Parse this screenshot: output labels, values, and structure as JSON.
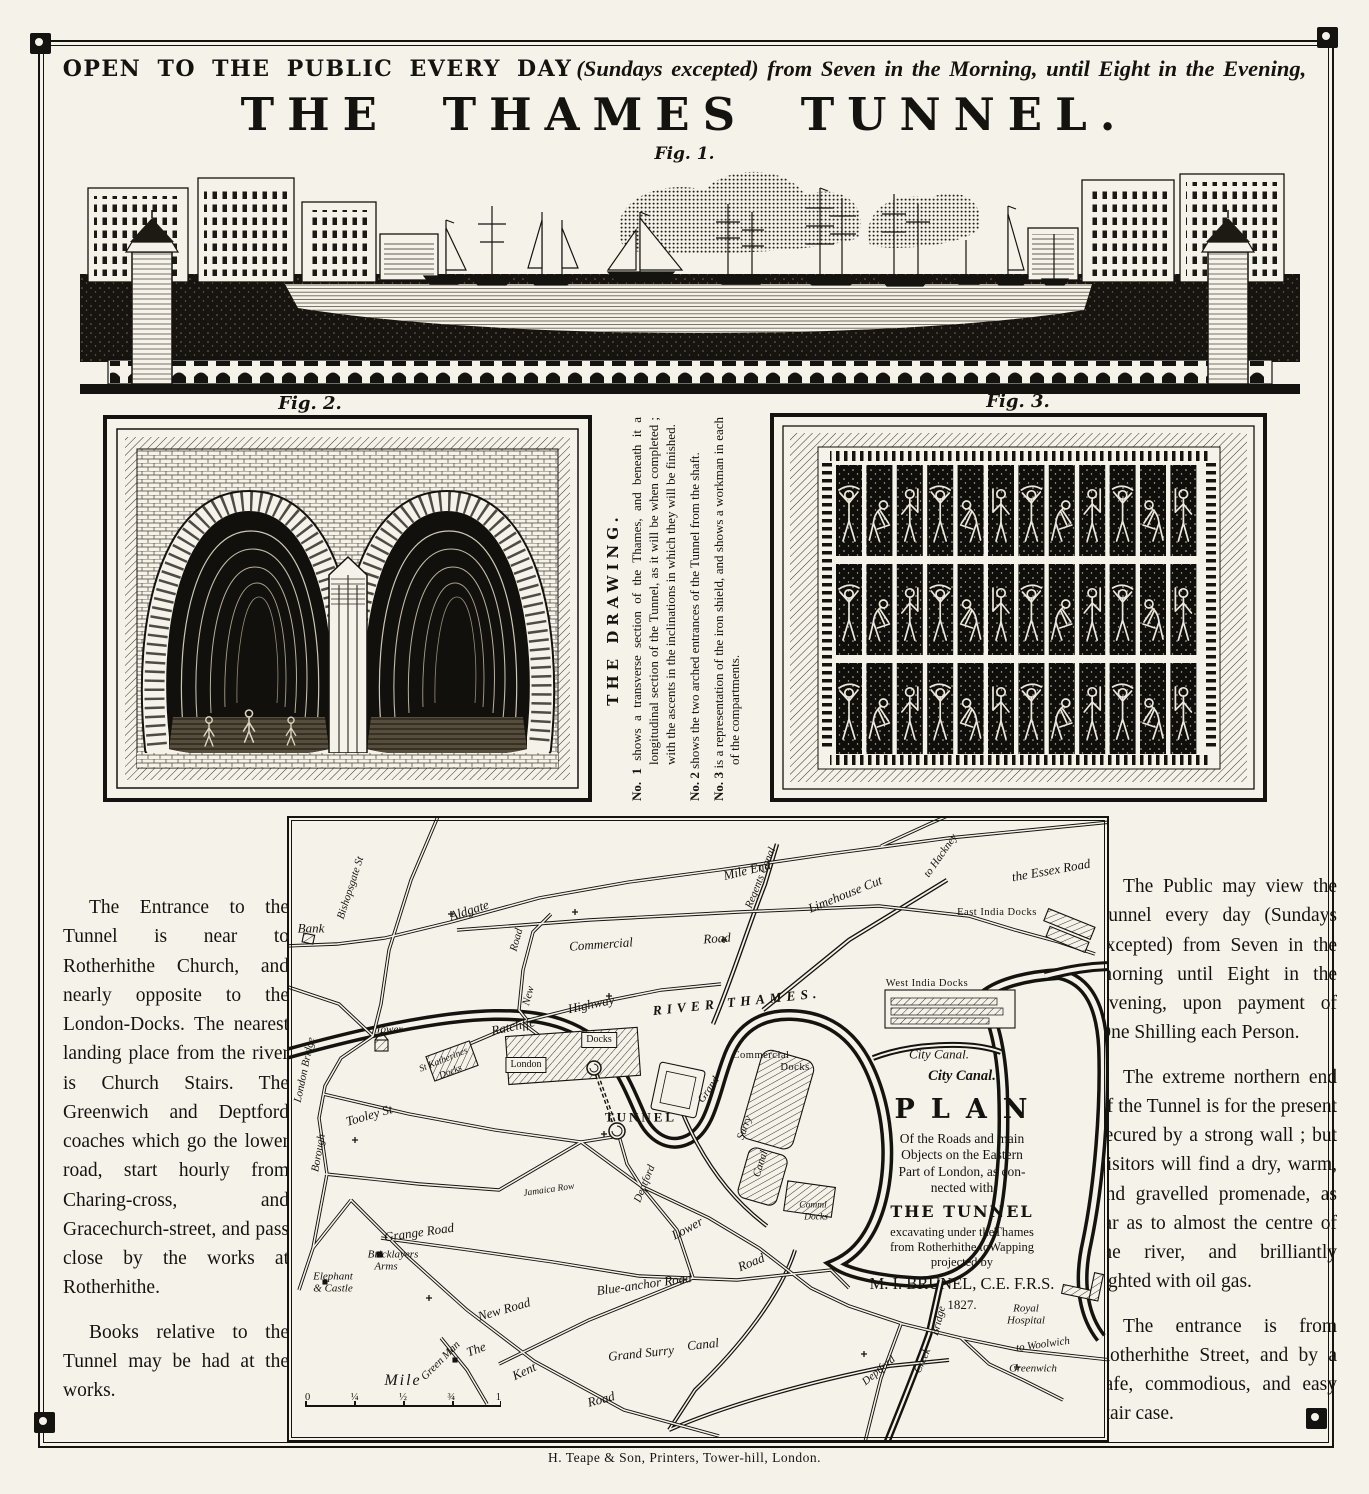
{
  "header": {
    "line1_bold": "OPEN TO THE PUBLIC EVERY DAY",
    "line1_italic": "(Sundays excepted) from Seven in the Morning, until Eight in the Evening,",
    "title": "THE THAMES TUNNEL.",
    "fig1_caption": "Fig. 1."
  },
  "figures": {
    "fig2_caption": "Fig. 2.",
    "fig3_caption": "Fig. 3."
  },
  "drawing_notes": {
    "heading": "THE DRAWING.",
    "notes": [
      {
        "label": "No. 1",
        "text": "shows a transverse section of the Thames, and beneath it a longitudinal section of the Tunnel, as it will be when completed ; with the ascents in the inclinations in which they will be finished."
      },
      {
        "label": "No. 2",
        "text": "shows the two arched entrances of the Tunnel from the shaft."
      },
      {
        "label": "No. 3",
        "text": "is a representation of the iron shield, and shows a workman in each of the compartments."
      }
    ]
  },
  "left_column": {
    "para1": "The Entrance to the Tunnel is near to Rotherhithe Church, and nearly opposite to the London-Docks.  The nearest landing place from the river is Church Stairs.  The Greenwich and Deptford coaches which go the lower road, start hourly from Charing-cross, and Gracechurch-street, and pass close by the works at Rotherhithe.",
    "para2": "Books relative to the Tunnel may be had at the works."
  },
  "right_column": {
    "para1": "The Public may view the Tunnel every day (Sundays excepted) from Seven in the morning until Eight in the Evening, upon payment of One Shilling each Person.",
    "para2": "The extreme northern end of the Tunnel is for the present secured by a strong wall ; but visitors will find a dry, warm, and gravelled promenade, as far as to almost the centre of the river, and brilliantly lighted with oil gas.",
    "para3": "The entrance is from Rotherhithe Street, and by a safe, commodious, and easy stair case."
  },
  "map": {
    "plan_block": {
      "canal": "City Canal.",
      "title": "PLAN",
      "lines": [
        "Of the Roads and main",
        "Objects on the Eastern",
        "Part of London, as con-",
        "nected with"
      ],
      "tunnel": "THE TUNNEL",
      "lines2": [
        "excavating under theThames",
        "from Rotherhithe toWapping",
        "projected by"
      ],
      "author": "M. I. BRUNEL, C.E. F.R.S.",
      "year": "1827."
    },
    "scale": {
      "label": "Mile",
      "ticks": [
        "0",
        "¼",
        "½",
        "¾",
        "1"
      ]
    },
    "labels": [
      {
        "text": "Bank",
        "x": 22,
        "y": 110,
        "rot": 0,
        "cls": "it"
      },
      {
        "text": "Bishopsgate St",
        "x": 62,
        "y": 70,
        "rot": -72,
        "cls": "it-sm"
      },
      {
        "text": "London Bridge",
        "x": 16,
        "y": 252,
        "rot": -78,
        "cls": "it-sm"
      },
      {
        "text": "Borough",
        "x": 30,
        "y": 335,
        "rot": -80,
        "cls": "it-sm"
      },
      {
        "text": "Aldgate",
        "x": 180,
        "y": 92,
        "rot": -18,
        "cls": "it"
      },
      {
        "text": "Mile End",
        "x": 458,
        "y": 52,
        "rot": -14,
        "cls": "it"
      },
      {
        "text": "to Hackney",
        "x": 652,
        "y": 38,
        "rot": -55,
        "cls": "it-sm"
      },
      {
        "text": "the Essex Road",
        "x": 762,
        "y": 52,
        "rot": -10,
        "cls": "it"
      },
      {
        "text": "Commercial",
        "x": 312,
        "y": 126,
        "rot": -4,
        "cls": "it"
      },
      {
        "text": "Road",
        "x": 428,
        "y": 120,
        "rot": -4,
        "cls": "it"
      },
      {
        "text": "Road",
        "x": 228,
        "y": 122,
        "rot": -75,
        "cls": "it-sm"
      },
      {
        "text": "New",
        "x": 240,
        "y": 178,
        "rot": -75,
        "cls": "it-sm"
      },
      {
        "text": "Ratcliffe",
        "x": 224,
        "y": 208,
        "rot": -12,
        "cls": "it"
      },
      {
        "text": "Highway",
        "x": 302,
        "y": 186,
        "rot": -12,
        "cls": "it"
      },
      {
        "text": "Tower",
        "x": 100,
        "y": 212,
        "rot": 0,
        "cls": "it-sm"
      },
      {
        "text": "St Katherines",
        "x": 155,
        "y": 243,
        "rot": -22,
        "cls": "tiny"
      },
      {
        "text": "Docks",
        "x": 162,
        "y": 255,
        "rot": -22,
        "cls": "tiny"
      },
      {
        "text": "London",
        "x": 237,
        "y": 247,
        "rot": 0,
        "cls": "box"
      },
      {
        "text": "Docks",
        "x": 310,
        "y": 222,
        "rot": 0,
        "cls": "box"
      },
      {
        "text": "TUNNEL",
        "x": 352,
        "y": 299,
        "rot": 0,
        "cls": "caps"
      },
      {
        "text": "Tooley St",
        "x": 80,
        "y": 297,
        "rot": -16,
        "cls": "it"
      },
      {
        "text": "Jamaica Row",
        "x": 260,
        "y": 373,
        "rot": -8,
        "cls": "tiny"
      },
      {
        "text": "Deptford",
        "x": 356,
        "y": 366,
        "rot": -68,
        "cls": "it-sm"
      },
      {
        "text": "Lower",
        "x": 398,
        "y": 410,
        "rot": -28,
        "cls": "it"
      },
      {
        "text": "Road",
        "x": 462,
        "y": 444,
        "rot": -22,
        "cls": "it"
      },
      {
        "text": "Grange Road",
        "x": 130,
        "y": 414,
        "rot": -8,
        "cls": "it"
      },
      {
        "text": "Bricklayers",
        "x": 104,
        "y": 437,
        "rot": 0,
        "cls": "it-sm"
      },
      {
        "text": "Arms",
        "x": 97,
        "y": 449,
        "rot": 0,
        "cls": "it-sm"
      },
      {
        "text": "Elephant",
        "x": 44,
        "y": 459,
        "rot": 0,
        "cls": "it-sm"
      },
      {
        "text": "& Castle",
        "x": 44,
        "y": 471,
        "rot": 0,
        "cls": "it-sm"
      },
      {
        "text": "New Road",
        "x": 215,
        "y": 491,
        "rot": -16,
        "cls": "it"
      },
      {
        "text": "Blue-anchor Road",
        "x": 355,
        "y": 466,
        "rot": -8,
        "cls": "it"
      },
      {
        "text": "Green Man",
        "x": 152,
        "y": 543,
        "rot": -45,
        "cls": "it-sm"
      },
      {
        "text": "The",
        "x": 187,
        "y": 531,
        "rot": -20,
        "cls": "it"
      },
      {
        "text": "Kent",
        "x": 235,
        "y": 553,
        "rot": -25,
        "cls": "it"
      },
      {
        "text": "Road",
        "x": 312,
        "y": 581,
        "rot": -15,
        "cls": "it"
      },
      {
        "text": "Grand Surry",
        "x": 352,
        "y": 535,
        "rot": -6,
        "cls": "it"
      },
      {
        "text": "Canal",
        "x": 414,
        "y": 526,
        "rot": -6,
        "cls": "it"
      },
      {
        "text": "Grand",
        "x": 420,
        "y": 272,
        "rot": -55,
        "cls": "it-sm"
      },
      {
        "text": "Surry",
        "x": 456,
        "y": 310,
        "rot": -70,
        "cls": "it-sm"
      },
      {
        "text": "Canal",
        "x": 472,
        "y": 346,
        "rot": -72,
        "cls": "it-sm"
      },
      {
        "text": "Commercial",
        "x": 472,
        "y": 238,
        "rot": 0,
        "cls": "sm"
      },
      {
        "text": "Docks",
        "x": 506,
        "y": 250,
        "rot": 0,
        "cls": "sm"
      },
      {
        "text": "Comml",
        "x": 524,
        "y": 388,
        "rot": 0,
        "cls": "tiny"
      },
      {
        "text": "Docks",
        "x": 527,
        "y": 400,
        "rot": 0,
        "cls": "tiny"
      },
      {
        "text": "Regents Canal",
        "x": 472,
        "y": 60,
        "rot": -68,
        "cls": "it-sm"
      },
      {
        "text": "Limehouse Cut",
        "x": 556,
        "y": 76,
        "rot": -22,
        "cls": "it"
      },
      {
        "text": "East India Docks",
        "x": 708,
        "y": 95,
        "rot": 0,
        "cls": "sm"
      },
      {
        "text": "West India Docks",
        "x": 638,
        "y": 166,
        "rot": 0,
        "cls": "sm"
      },
      {
        "text": "RIVER THAMES.",
        "x": 448,
        "y": 184,
        "rot": -6,
        "cls": "river"
      },
      {
        "text": "Royal",
        "x": 737,
        "y": 491,
        "rot": 0,
        "cls": "it-sm"
      },
      {
        "text": "Hospital",
        "x": 737,
        "y": 503,
        "rot": 0,
        "cls": "it-sm"
      },
      {
        "text": "to Woolwich",
        "x": 754,
        "y": 527,
        "rot": -8,
        "cls": "it-sm"
      },
      {
        "text": "Greenwich",
        "x": 744,
        "y": 551,
        "rot": 0,
        "cls": "it-sm"
      },
      {
        "text": "Deptford",
        "x": 590,
        "y": 553,
        "rot": -40,
        "cls": "it-sm"
      },
      {
        "text": "Creek",
        "x": 634,
        "y": 543,
        "rot": -66,
        "cls": "it-sm"
      },
      {
        "text": "Bridge",
        "x": 650,
        "y": 503,
        "rot": -76,
        "cls": "it-sm"
      },
      {
        "text": "City Canal.",
        "x": 650,
        "y": 236,
        "rot": 0,
        "cls": "it"
      }
    ]
  },
  "fig3": {
    "rows": 3,
    "columns": 12
  },
  "footer": {
    "imprint": "H. Teape & Son, Printers, Tower-hill, London."
  }
}
